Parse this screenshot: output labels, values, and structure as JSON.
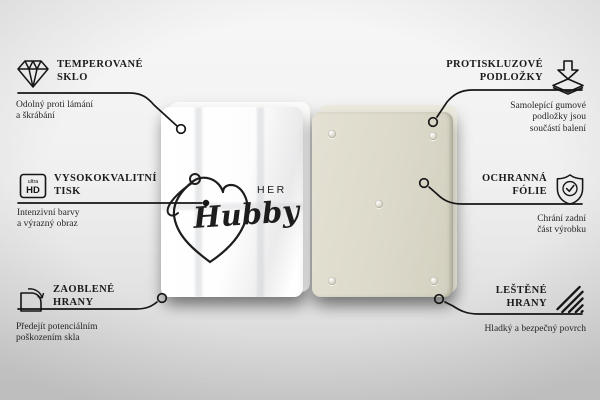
{
  "design": {
    "her": "HER",
    "hubby": "Hubby"
  },
  "ultra_hd_icon": {
    "ultra": "ultra",
    "hd": "HD"
  },
  "colors": {
    "line": "#161616",
    "glass": "#ffffff",
    "board_back": "#dcd9ca"
  },
  "callouts": [
    {
      "id": "tempered-glass",
      "title": "TEMPEROVANÉ\nSKLO",
      "description": "Odolný proti lámání\na škrábání"
    },
    {
      "id": "high-quality-print",
      "title": "VYSOKOKVALITNÍ\nTISK",
      "description": "Intenzivní barvy\na výrazný obraz"
    },
    {
      "id": "rounded-edges",
      "title": "ZAOBLENÉ\nHRANY",
      "description": "Předejít potenciálním\npoškozením skla"
    },
    {
      "id": "anti-slip-pads",
      "title": "PROTISKLUZOVÉ\nPODLOŽKY",
      "description": "Samolepící gumové\npodložky jsou\nsoučástí balení"
    },
    {
      "id": "protective-film",
      "title": "OCHRANNÁ\nFÓLIE",
      "description": "Chrání zadní\nčást výrobku"
    },
    {
      "id": "polished-edges",
      "title": "LEŠTĚNÉ\nHRANY",
      "description": "Hladký a bezpečný povrch"
    }
  ]
}
